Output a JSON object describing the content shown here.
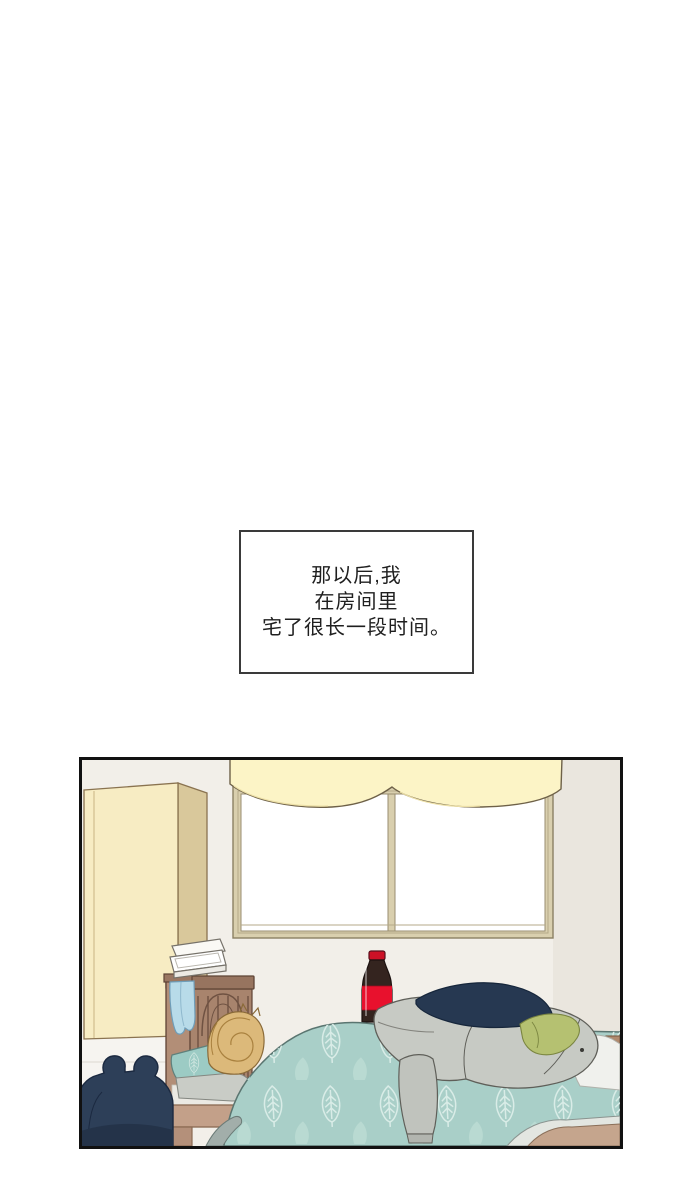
{
  "page": {
    "kind": "webtoon-comic-page",
    "background": "#ffffff"
  },
  "narration": {
    "lines": [
      "那以后,我",
      "在房间里",
      "宅了很长一段时间。"
    ],
    "border_color": "#3a3a3a",
    "text_color": "#1f1f1f"
  },
  "panel": {
    "border_color": "#111111",
    "scene": "bedroom with person sleeping in bed",
    "objects": [
      "wardrobe",
      "window",
      "valance-curtain",
      "cola-bottle",
      "headboard",
      "open-white-box",
      "towel",
      "pillow",
      "sleeping-person",
      "leaf-blanket",
      "gray-jacket",
      "navy-cloth",
      "green-cloth",
      "white-sheet",
      "backpack"
    ],
    "colors": {
      "wall": "#f2efe9",
      "wall_right": "#eae6de",
      "wardrobe_front": "#f7ecc3",
      "wardrobe_side": "#d9c89b",
      "valance": "#fcf4c6",
      "window_frame": "#d9cfae",
      "window_pane": "#ffffff",
      "headboard": "#a8846d",
      "headboard_post": "#b28e77",
      "bed_rail": "#c3a089",
      "towel": "#b8dbe9",
      "pillow_teal": "#9ccbc4",
      "pillow_gray": "#c9ccc6",
      "hair": "#dcb97a",
      "cola_body": "#34241f",
      "cola_red": "#e8112d",
      "blanket": "#a9cfc8",
      "leaf_outline": "#d9ece7",
      "leaf_solid": "#b9dad2",
      "jacket": "#c7cac4",
      "cloth_navy": "#263851",
      "cloth_green": "#b5c171",
      "sheet_white": "#f0f1ed",
      "fold_tan": "#c5a58d",
      "backpack": "#2d3f58",
      "band_blue": "#cfe3ee"
    }
  }
}
